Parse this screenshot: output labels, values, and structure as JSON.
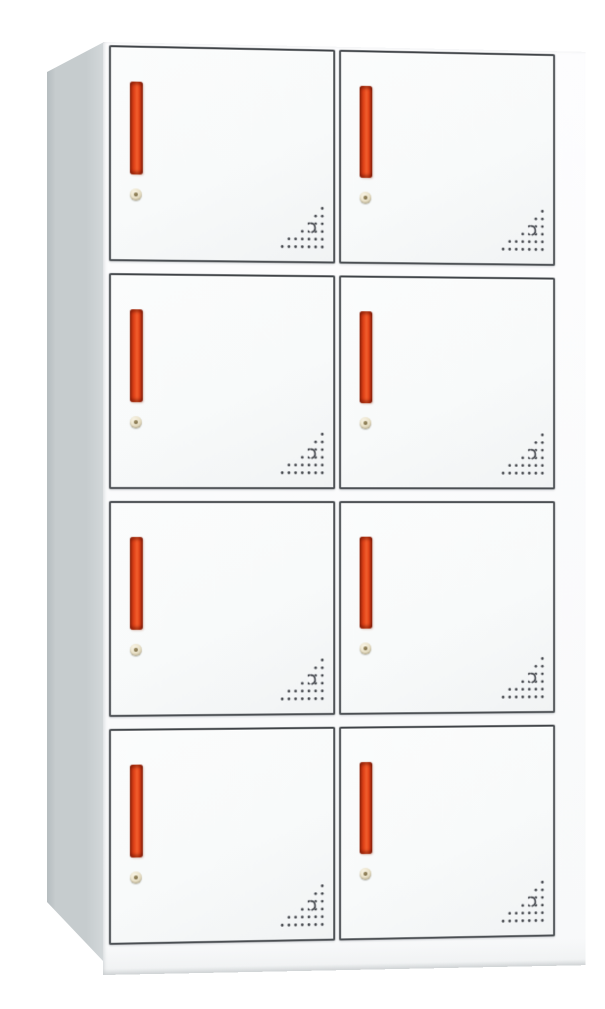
{
  "colors": {
    "background": "#ffffff",
    "side_panel": "#c6ccce",
    "side_panel_dark": "#b2b9bc",
    "side_panel_light": "#d3d8da",
    "front_white": "#fdfdfe",
    "door_face": "#fbfcfc",
    "door_face_shade": "#f1f3f4",
    "door_border": "#4a4e52",
    "handle_red": "#e8481c",
    "handle_red_light": "#f0602e",
    "handle_red_dark": "#9e2a10",
    "lock_body": "#ece4cc",
    "lock_rim": "#c9bfa0",
    "lock_keyhole": "#6e5f3d",
    "vent_dot": "#41444a",
    "base_shadow": "#c9cdcf"
  },
  "cabinet": {
    "type": "metal-locker-cabinet",
    "rows": 4,
    "columns": 2,
    "door_count": 8,
    "door_features": {
      "handle_icon": "vertical-bar-handle",
      "lock_icon": "keyhole-lock",
      "vent_icon": "vent-perforation-triangle"
    },
    "doors": [
      {
        "id": 1,
        "row": 1,
        "col": 1
      },
      {
        "id": 2,
        "row": 1,
        "col": 2
      },
      {
        "id": 3,
        "row": 2,
        "col": 1
      },
      {
        "id": 4,
        "row": 2,
        "col": 2
      },
      {
        "id": 5,
        "row": 3,
        "col": 1
      },
      {
        "id": 6,
        "row": 3,
        "col": 2
      },
      {
        "id": 7,
        "row": 4,
        "col": 1
      },
      {
        "id": 8,
        "row": 4,
        "col": 2
      }
    ],
    "vent_pattern": {
      "shape": "right-triangle-bottom-right",
      "rows": [
        [
          6
        ],
        [
          5,
          6
        ],
        [
          4,
          5,
          6
        ],
        [
          3,
          4,
          5,
          6
        ],
        [
          1,
          2,
          3,
          4,
          5,
          6
        ],
        [
          0,
          1,
          2,
          3,
          4,
          5,
          6
        ]
      ],
      "crescent": true
    }
  }
}
